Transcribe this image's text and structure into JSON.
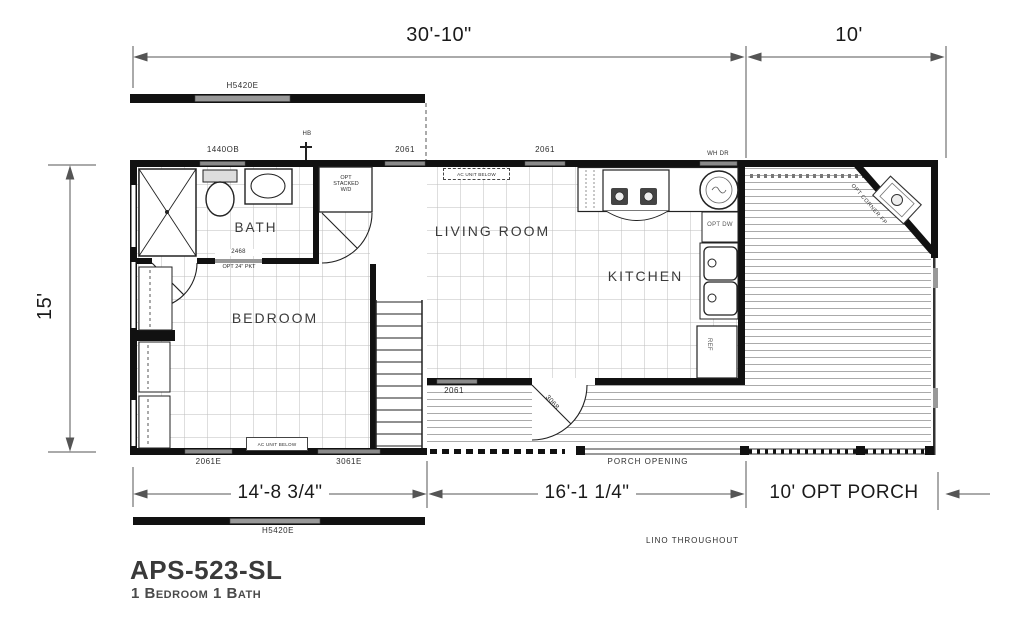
{
  "title": {
    "model": "APS-523-SL",
    "subtitle": "1 Bedroom 1 Bath"
  },
  "dims": {
    "top_main": "30'-10\"",
    "top_porch": "10'",
    "left": "15'",
    "bottom_left": "14'-8 3/4\"",
    "bottom_mid": "16'-1 1/4\"",
    "bottom_porch": "10' OPT PORCH"
  },
  "rooms": {
    "bath": "BATH",
    "bedroom": "BEDROOM",
    "living": "LIVING ROOM",
    "kitchen": "KITCHEN"
  },
  "labels": {
    "hitch_top": "H5420E",
    "hitch_bottom": "H5420E",
    "win_1440ob": "1440OB",
    "hose_bib": "HB",
    "win_2061_a": "2061",
    "win_2061_b": "2061",
    "wh_door": "WH DR",
    "opt_dw": "OPT DW",
    "ref": "REF",
    "win_2061e": "2061E",
    "win_3061e": "3061E",
    "win_2061_c": "2061",
    "door_3068": "3068",
    "pocket_size": "2468",
    "pocket_opt": "OPT 24\" PKT",
    "wd_line1": "OPT",
    "wd_line2": "STACKED",
    "wd_line3": "W/D",
    "corner_fp": "OPT CORNER FP",
    "porch_opening": "PORCH OPENING",
    "lino": "LINO THROUGHOUT",
    "ac_bedroom": "AC UNIT BELOW",
    "ac_living": "AC UNIT BELOW"
  },
  "colors": {
    "wall": "#111111",
    "dimension_line": "#555555",
    "carpet_grid": "#bdbdbd",
    "deck_line": "#a0a0a0",
    "window_fill": "#8a8a8a"
  }
}
